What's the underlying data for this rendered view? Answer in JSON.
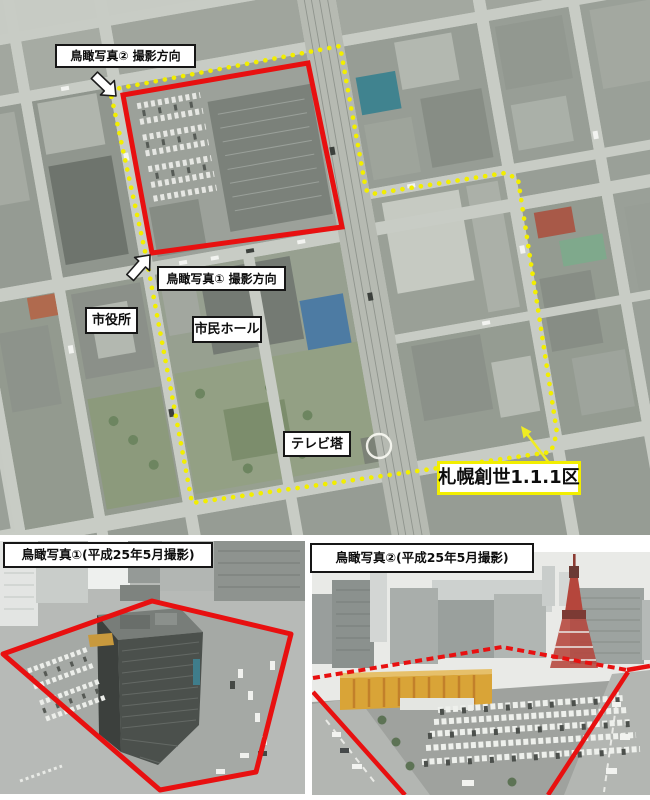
{
  "figure": {
    "map_labels": {
      "photo2_direction": "鳥瞰写真② 撮影方向",
      "photo1_direction": "鳥瞰写真① 撮影方向",
      "city_hall": "市役所",
      "civic_hall": "市民ホール",
      "tv_tower": "テレビ塔",
      "district_name": "札幌創世1.1.1区"
    },
    "photo_captions": {
      "photo1": "鳥瞰写真①(平成25年5月撮影)",
      "photo2": "鳥瞰写真②(平成25年5月撮影)"
    },
    "colors": {
      "district_boundary_dotted": "#f2ee00",
      "block_outline_red": "#e81010"
    }
  }
}
